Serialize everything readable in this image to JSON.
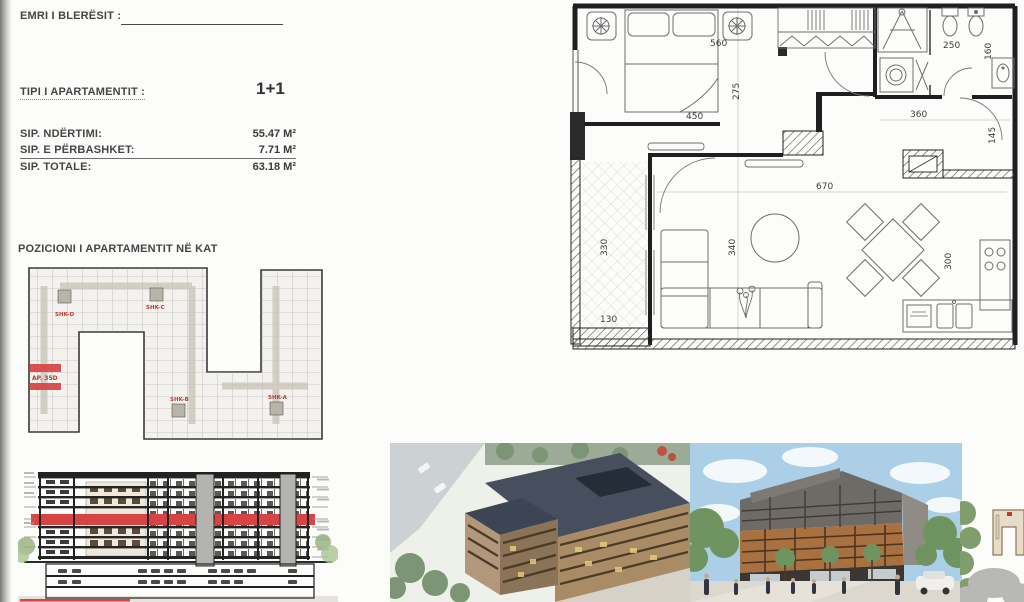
{
  "colors": {
    "highlight_red": "#d84343",
    "label_red": "#c0392b",
    "ink": "#3f3f3f"
  },
  "info": {
    "buyer_label": "EMRI I BLERËSIT :",
    "type_label": "TIPI I APARTAMENTIT :",
    "type_value": "1+1",
    "areas": [
      {
        "label": "SIP. NDËRTIMI:",
        "value": "55.47 M²"
      },
      {
        "label": "SIP. E PËRBASHKET:",
        "value": "7.71 M²"
      },
      {
        "label": "SIP. TOTALE:",
        "value": "63.18 M²"
      }
    ],
    "position_title": "POZICIONI I APARTAMENTIT NË KAT"
  },
  "position_plan": {
    "apartment": "AP. 35D",
    "shk_d": "SHK-D",
    "shk_c": "SHK-C",
    "shk_b": "SHK-B",
    "shk_a": "SHK-A"
  },
  "main_plan": {
    "dims": {
      "d560": "560",
      "d275": "275",
      "d450": "450",
      "d250": "250",
      "d160": "160",
      "d360": "360",
      "d145": "145",
      "d670": "670",
      "d330": "330",
      "d130": "130",
      "d340": "340",
      "d300": "300"
    }
  }
}
